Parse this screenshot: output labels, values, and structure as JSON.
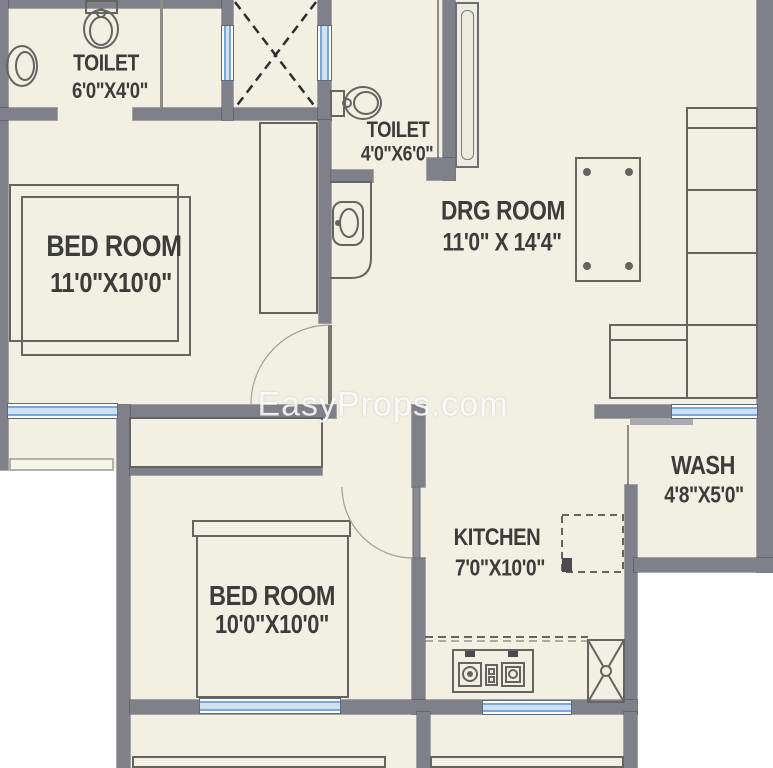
{
  "watermark": "EasyProps.com",
  "rooms": {
    "toilet1": {
      "name": "TOILET",
      "dims": "6'0\"X4'0\""
    },
    "toilet2": {
      "name": "TOILET",
      "dims": "4'0\"X6'0\""
    },
    "bedroom1": {
      "name": "BED ROOM",
      "dims": "11'0\"X10'0\""
    },
    "drawing_room": {
      "name": "DRG ROOM",
      "dims": "11'0\" X 14'4\""
    },
    "wash": {
      "name": "WASH",
      "dims": "4'8\"X5'0\""
    },
    "kitchen": {
      "name": "KITCHEN",
      "dims": "7'0\"X10'0\""
    },
    "bedroom2": {
      "name": "BED ROOM",
      "dims": "10'0\"X10'0\""
    }
  },
  "colors": {
    "floor": "#f1f0e3",
    "wall": "#80808a",
    "wall-dark": "#5f5f66",
    "window": "#7ca6d7",
    "window-light": "#cfe0f0",
    "line": "#65655f",
    "text": "#3c3c38",
    "outside": "#ffffff",
    "step": "#ababaf",
    "leaf": "#8a8a92"
  }
}
